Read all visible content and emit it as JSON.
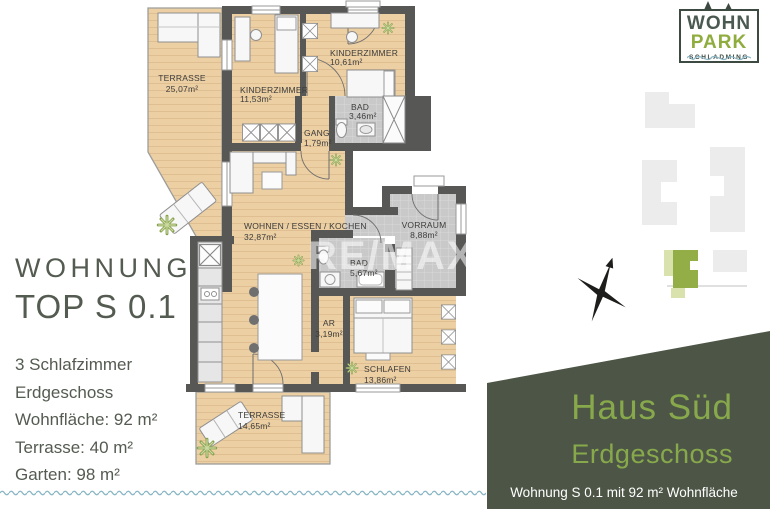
{
  "left_panel": {
    "title_line1": "WOHNUNG",
    "title_line2": "TOP S 0.1",
    "details": [
      "3 Schlafzimmer",
      "Erdgeschoss",
      "Wohnfläche: 92 m²",
      "Terrasse: 40 m²",
      "Garten: 98 m²"
    ]
  },
  "logo": {
    "line1": "WOHN",
    "line2": "PARK",
    "line3": "SCHLADMING"
  },
  "plan": {
    "watermark": "RE/MAX",
    "rooms": [
      {
        "name": "TERRASSE",
        "area": "25,07m²"
      },
      {
        "name": "KINDERZIMMER",
        "area": "11,53m²"
      },
      {
        "name": "KINDERZIMMER",
        "area": "10,61m²"
      },
      {
        "name": "BAD",
        "area": "3,46m²"
      },
      {
        "name": "GANG",
        "area": "1,79m²"
      },
      {
        "name": "WOHNEN / ESSEN / KOCHEN",
        "area": "32,87m²"
      },
      {
        "name": "VORRAUM",
        "area": "8,88m²"
      },
      {
        "name": "BAD",
        "area": "5,67m²"
      },
      {
        "name": "AR",
        "area": "3,19m²"
      },
      {
        "name": "SCHLAFEN",
        "area": "13,86m²"
      },
      {
        "name": "TERRASSE",
        "area": "14,65m²"
      }
    ]
  },
  "info_panel": {
    "house": "Haus Süd",
    "floor": "Erdgeschoss",
    "caption": "Wohnung S 0.1 mit 92 m² Wohnfläche"
  },
  "colors": {
    "wall": "#575756",
    "wood": "#eccfa3",
    "tile": "#c9c9c9",
    "panel_green": "#4d5646",
    "accent_green": "#87a94c",
    "logo_green": "#8fac3e",
    "wave_blue": "#8ab6c5",
    "text": "#545b51"
  }
}
